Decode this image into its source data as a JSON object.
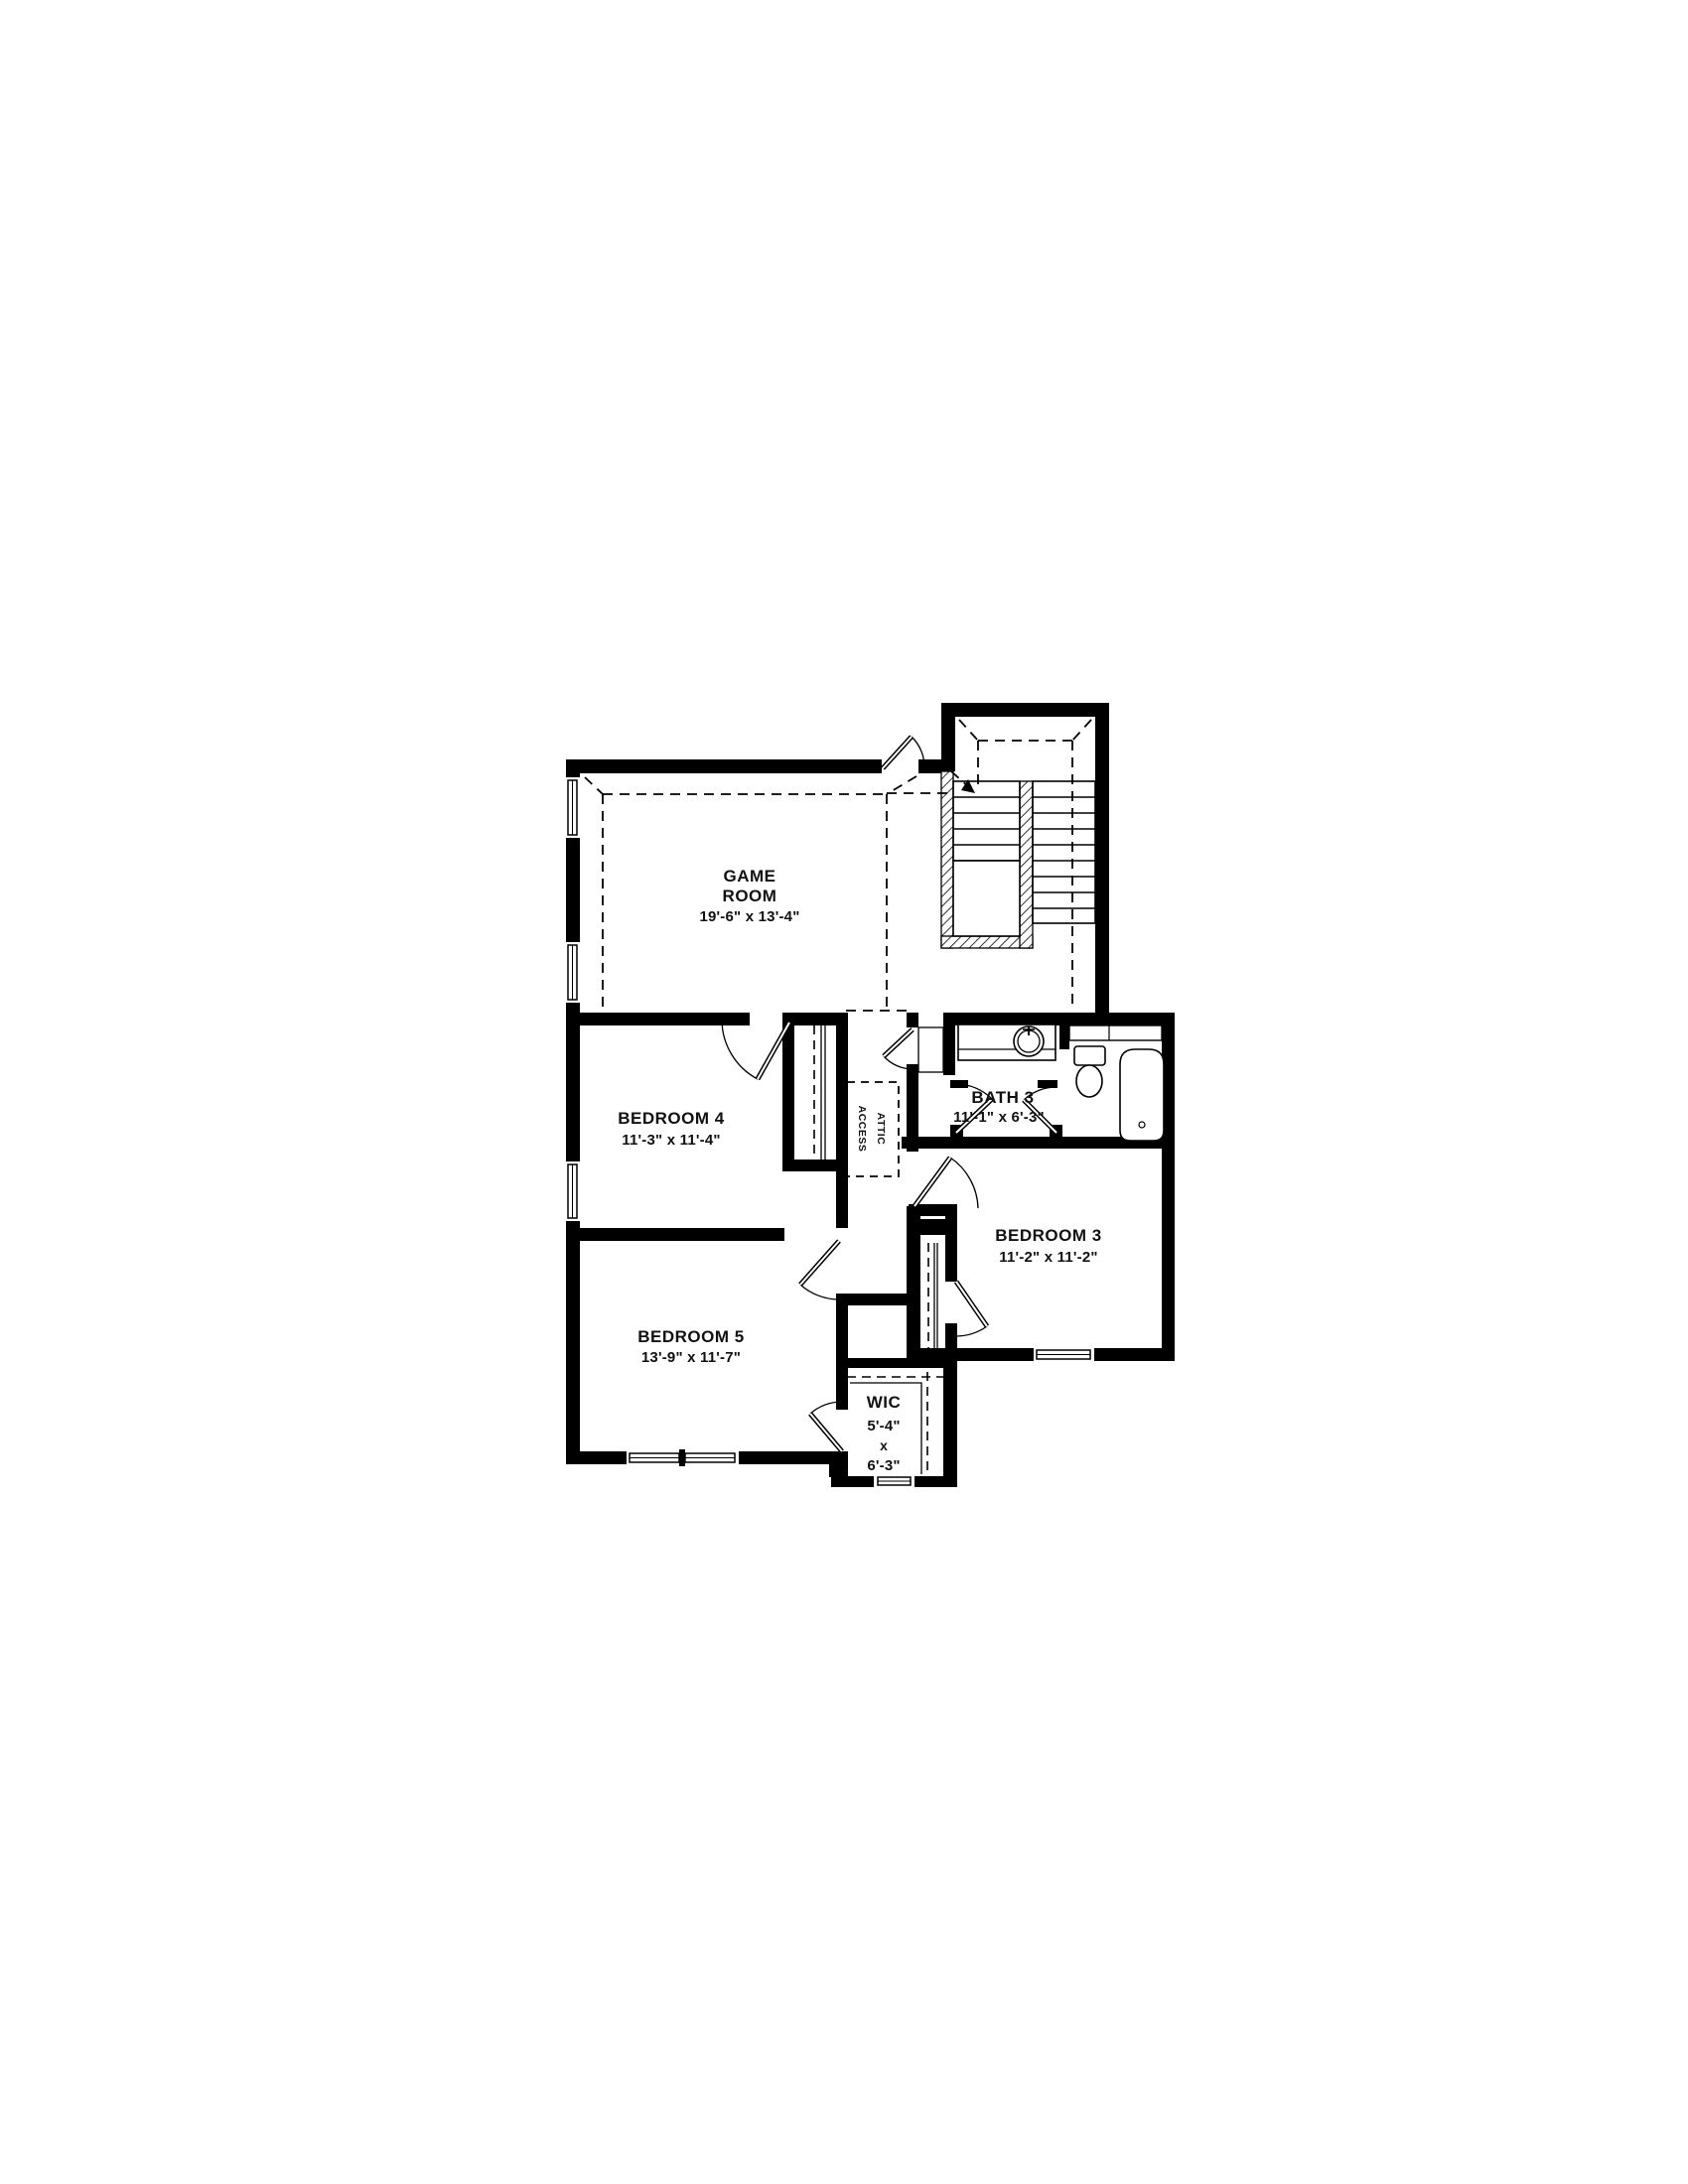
{
  "plan": {
    "title": "Second floor residential floor plan",
    "wall_color": "#000000",
    "background_color": "#ffffff",
    "rooms": {
      "game_room": {
        "name_line1": "GAME",
        "name_line2": "ROOM",
        "dimensions": "19'-6\" x 13'-4\""
      },
      "bedroom_4": {
        "name": "BEDROOM 4",
        "dimensions": "11'-3\" x 11'-4\""
      },
      "bath_3": {
        "name": "BATH 3",
        "dimensions": "11'-1\" x 6'-3\""
      },
      "bedroom_3": {
        "name": "BEDROOM 3",
        "dimensions": "11'-2\" x 11'-2\""
      },
      "bedroom_5": {
        "name": "BEDROOM 5",
        "dimensions": "13'-9\" x 11'-7\""
      },
      "wic": {
        "name": "WIC",
        "dim_width": "5'-4\"",
        "dim_sep": "x",
        "dim_depth": "6'-3\""
      },
      "attic_access": {
        "name_line1": "ATTIC",
        "name_line2": "ACCESS"
      }
    },
    "fixtures": [
      "staircase",
      "bathtub",
      "toilet",
      "vanity-sink",
      "closet-rods",
      "attic-access-panel",
      "windows",
      "doors"
    ]
  }
}
